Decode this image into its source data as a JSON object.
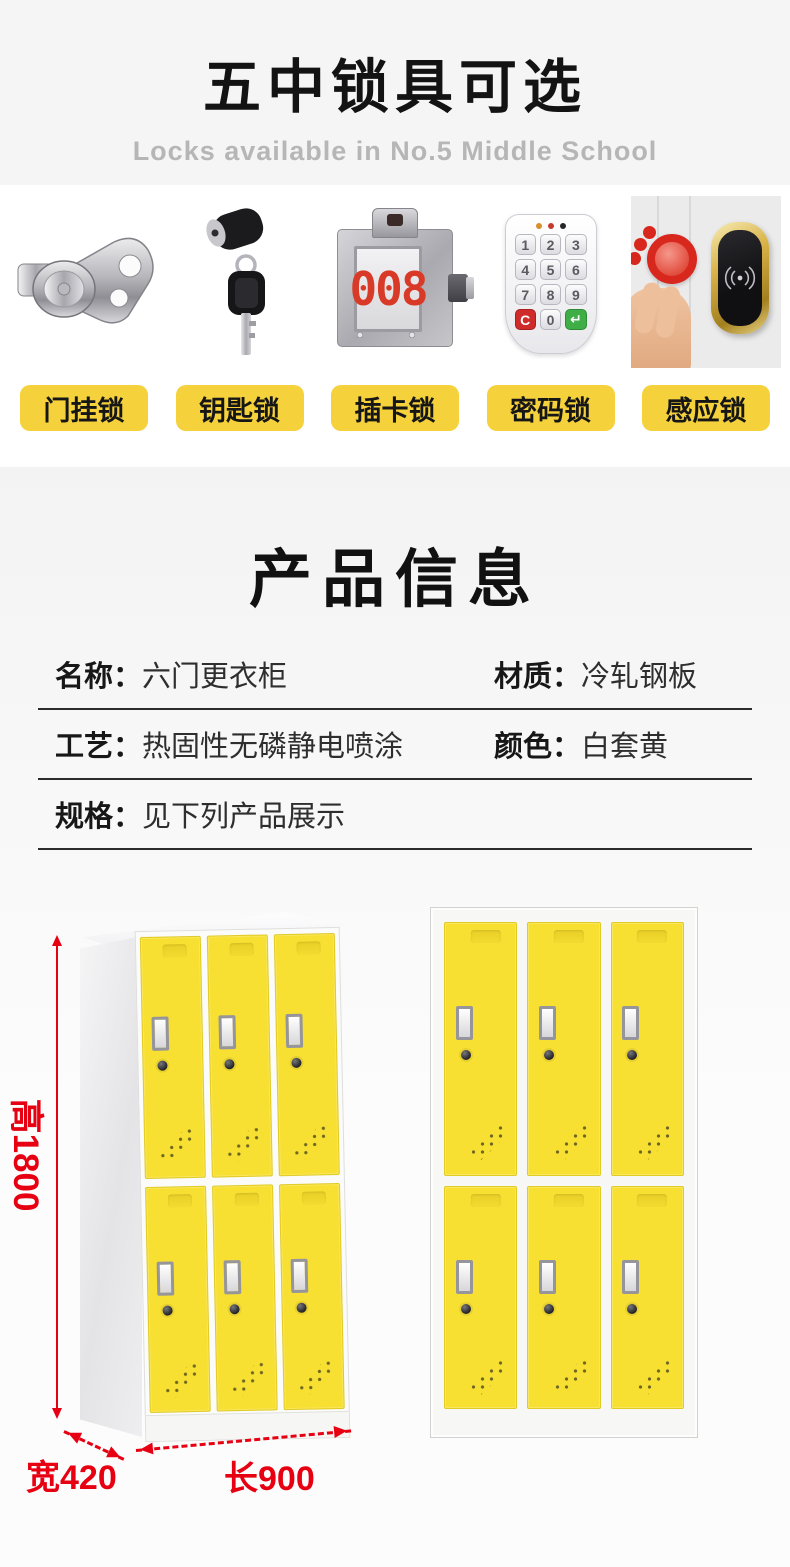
{
  "colors": {
    "accent_yellow": "#f5d13b",
    "door_yellow": "#f8e033",
    "dimension_red": "#e60012",
    "lock_number_red": "#d93a28",
    "header_background": "#f5f5f5"
  },
  "header": {
    "title": "五中锁具可选",
    "subtitle": "Locks available in No.5 Middle School"
  },
  "locks": {
    "items": [
      {
        "label": "门挂锁"
      },
      {
        "label": "钥匙锁"
      },
      {
        "label": "插卡锁"
      },
      {
        "label": "密码锁"
      },
      {
        "label": "感应锁"
      }
    ],
    "card_lock": {
      "number": "008"
    },
    "keypad": {
      "keys": [
        "1",
        "2",
        "3",
        "4",
        "5",
        "6",
        "7",
        "8",
        "9",
        "C",
        "0",
        "↵"
      ]
    }
  },
  "product_info": {
    "title": "产品信息",
    "rows": [
      {
        "label": "名称：",
        "value": "六门更衣柜"
      },
      {
        "label": "材质：",
        "value": "冷轧钢板"
      },
      {
        "label": "工艺：",
        "value": "热固性无磷静电喷涂"
      },
      {
        "label": "颜色：",
        "value": "白套黄"
      },
      {
        "label": "规格：",
        "value": "见下列产品展示"
      }
    ]
  },
  "dimensions": {
    "height": "高1800",
    "width": "宽420",
    "length": "长900"
  }
}
